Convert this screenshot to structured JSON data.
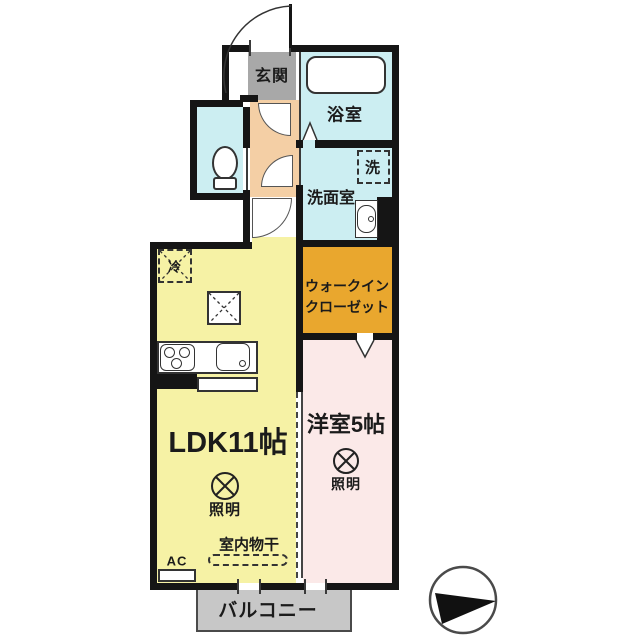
{
  "floorplan": {
    "rooms": {
      "genkan": "玄関",
      "bathroom": "浴室",
      "washer": "洗",
      "washroom": "洗面室",
      "wic_line1": "ウォークイン",
      "wic_line2": "クローゼット",
      "fridge": "冷",
      "ldk": "LDK11帖",
      "western": "洋室5帖",
      "light": "照明",
      "drying": "室内物干",
      "ac": "AC",
      "balcony": "バルコニー"
    },
    "colors": {
      "wall": "#151515",
      "genkan_tile": "#a8a8a8",
      "hallway": "#f4cfa5",
      "wet_rooms": "#cceef2",
      "ldk": "#f6f2a5",
      "western_room": "#fbe9e8",
      "walk_in_closet": "#e9a72e",
      "balcony": "#c7c7c7"
    },
    "icons": {
      "compass": "north-arrow",
      "light_symbol": "circle-x"
    }
  }
}
